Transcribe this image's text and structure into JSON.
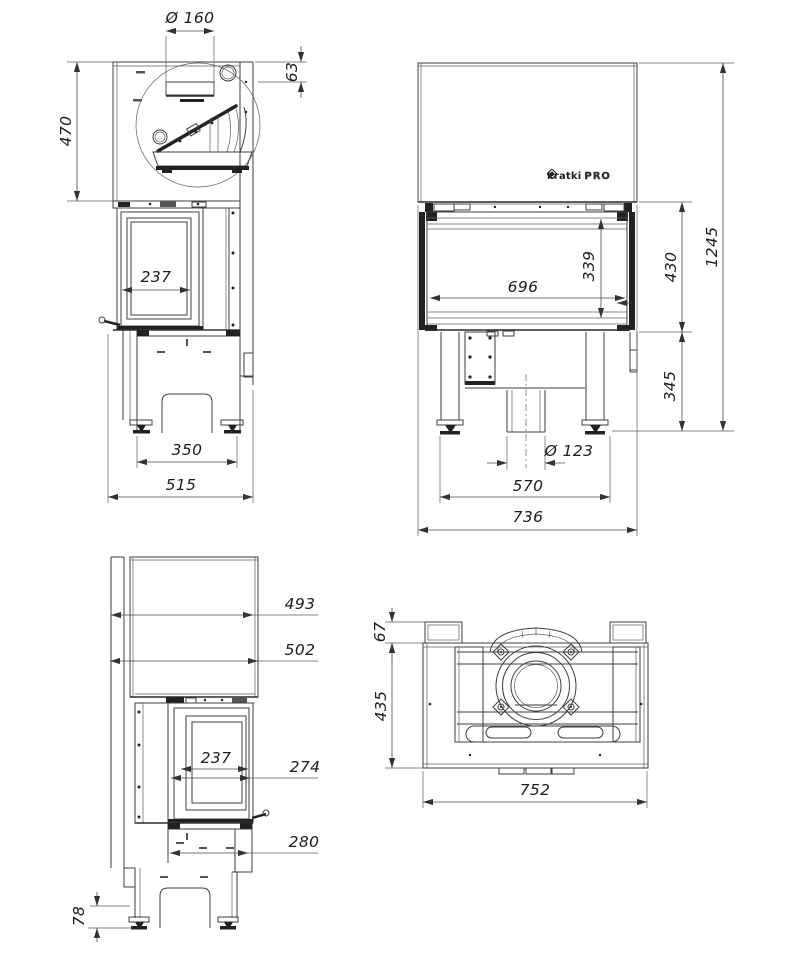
{
  "logo": {
    "name": "kratki",
    "suffix": "PRO"
  },
  "dims": {
    "flue_diameter": "Ø 160",
    "flue_rear_offset": "63",
    "hood_height": "470",
    "side_glass_width": "237",
    "front_foot_span": "350",
    "side_depth_total": "515",
    "overall_height": "1245",
    "firebox_height": "430",
    "front_glass_height": "339",
    "front_glass_width": "696",
    "base_height": "345",
    "air_inlet_diameter": "Ø 123",
    "front_leg_span": "570",
    "overall_width": "736",
    "hood_depth_inner": "493",
    "hood_depth_outer": "502",
    "rear_glass_width": "237",
    "door_depth": "274",
    "base_depth": "280",
    "foot_height": "78",
    "plan_rear_offset": "67",
    "plan_body_depth": "435",
    "plan_body_width": "752"
  }
}
